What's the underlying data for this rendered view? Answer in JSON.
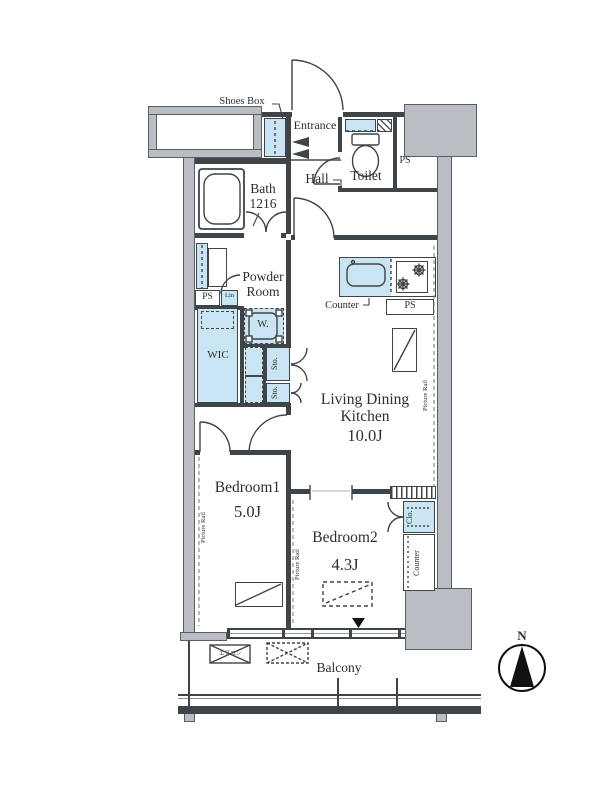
{
  "plan": {
    "labels": {
      "shoes_box": "Shoes Box",
      "entrance": "Entrance",
      "toilet": "Toilet",
      "ps_toilet": "PS",
      "hall": "Hall",
      "bath_name": "Bath",
      "bath_size": "1216",
      "powder_line1": "Powder",
      "powder_line2": "Room",
      "ps_powder": "PS",
      "linen": "Lin",
      "washer": "W.",
      "wic": "WIC",
      "sto_upper": "Sto.",
      "sto_lower": "Sto.",
      "counter_kitchen": "Counter",
      "ps_kitchen": "PS",
      "ldk_line1": "Living Dining",
      "ldk_line2": "Kitchen",
      "ldk_size": "10.0J",
      "picture_rail_ldk": "Picture Rail",
      "bedroom1_name": "Bedroom1",
      "bedroom1_size": "5.0J",
      "picture_rail_bedroom1": "Picture Rail",
      "bedroom2_name": "Bedroom2",
      "bedroom2_size": "4.3J",
      "picture_rail_bedroom2": "Picture Rail",
      "closet": "Clo.",
      "counter_bedroom2": "Counter",
      "balcony": "Balcony",
      "ac_unit": "エアコン",
      "compass_north": "N"
    },
    "colors": {
      "fixture_blue": "#c9e4f2",
      "wall_gray": "#b9bec4",
      "line": "#3f4448",
      "text": "#2b2f33"
    }
  }
}
